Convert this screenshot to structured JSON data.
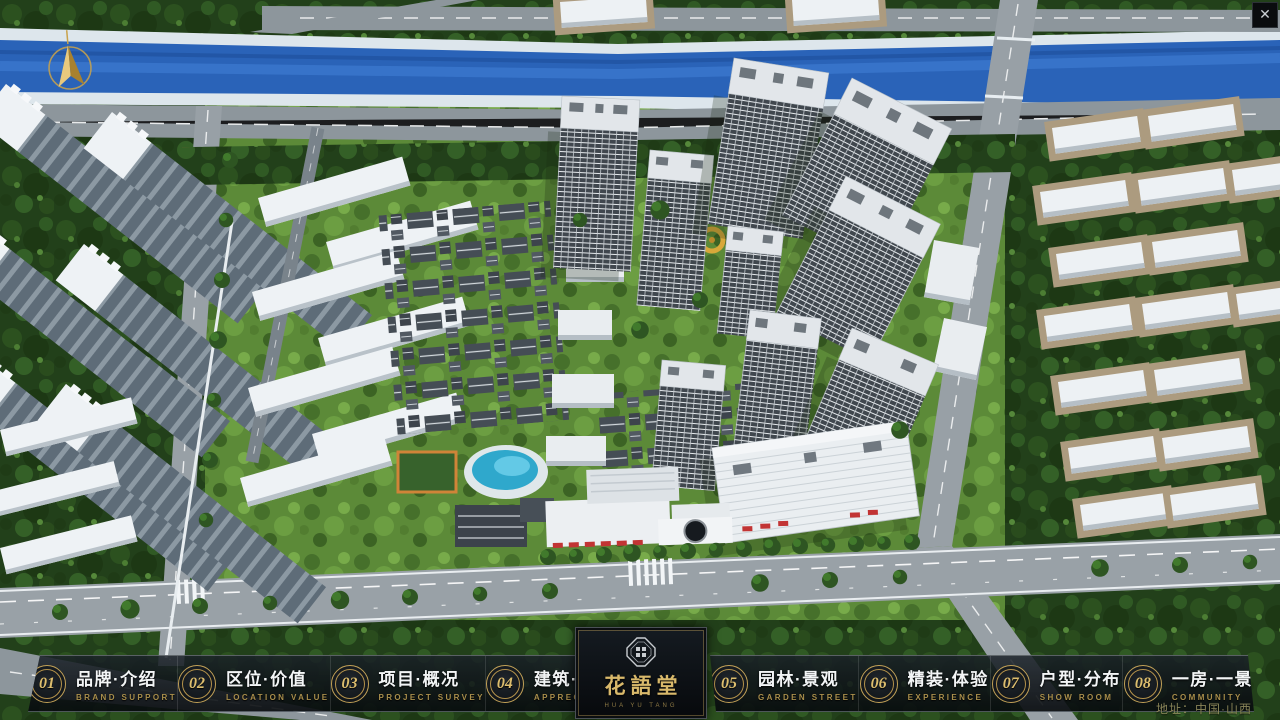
{
  "app": {
    "close_glyph": "✕"
  },
  "logo": {
    "title": "花語堂",
    "subtitle": "HUA YU TANG"
  },
  "map": {
    "address": "地址：中国·山西"
  },
  "nav": {
    "items": [
      {
        "num": "01",
        "cn": "品牌·介绍",
        "en": "BRAND SUPPORT"
      },
      {
        "num": "02",
        "cn": "区位·价值",
        "en": "LOCATION VALUE"
      },
      {
        "num": "03",
        "cn": "项目·概况",
        "en": "PROJECT SURVEY"
      },
      {
        "num": "04",
        "cn": "建筑·鉴赏",
        "en": "APPRECIATION"
      },
      {
        "num": "05",
        "cn": "园林·景观",
        "en": "GARDEN STREET"
      },
      {
        "num": "06",
        "cn": "精装·体验",
        "en": "EXPERIENCE"
      },
      {
        "num": "07",
        "cn": "户型·分布",
        "en": "SHOW ROOM"
      },
      {
        "num": "08",
        "cn": "一房·一景",
        "en": "COMMUNITY"
      }
    ]
  },
  "colors": {
    "gold": "#c9a85c",
    "water": "#2a63b8",
    "panel": "rgba(10,14,18,0.85)"
  }
}
